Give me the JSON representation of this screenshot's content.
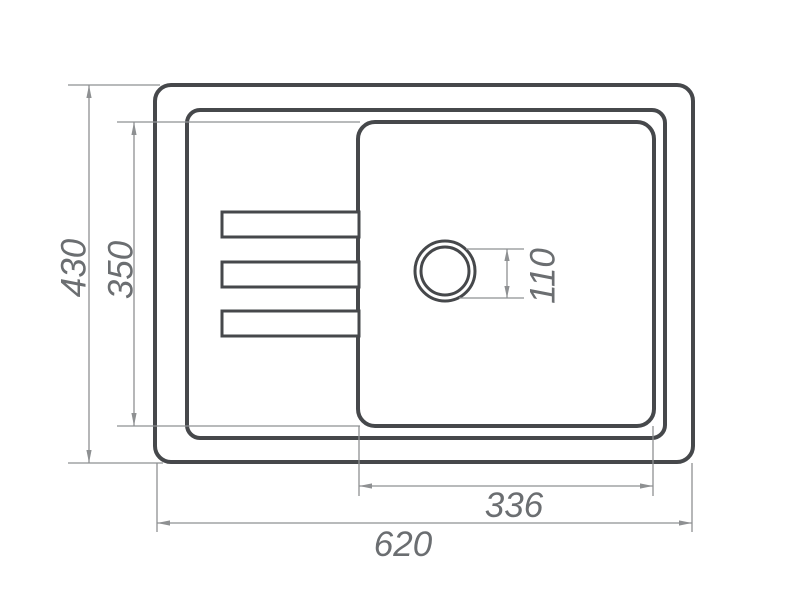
{
  "drawing": {
    "title": "Kitchen sink top-view dimensional drawing",
    "dims": {
      "overall_length": "620",
      "overall_depth": "430",
      "bowl_length": "336",
      "bowl_depth": "350",
      "drain_diameter": "110"
    },
    "colors": {
      "outline": "#46484b",
      "dimension": "#8e9092",
      "label": "#6b6e71",
      "background": "#ffffff"
    }
  }
}
